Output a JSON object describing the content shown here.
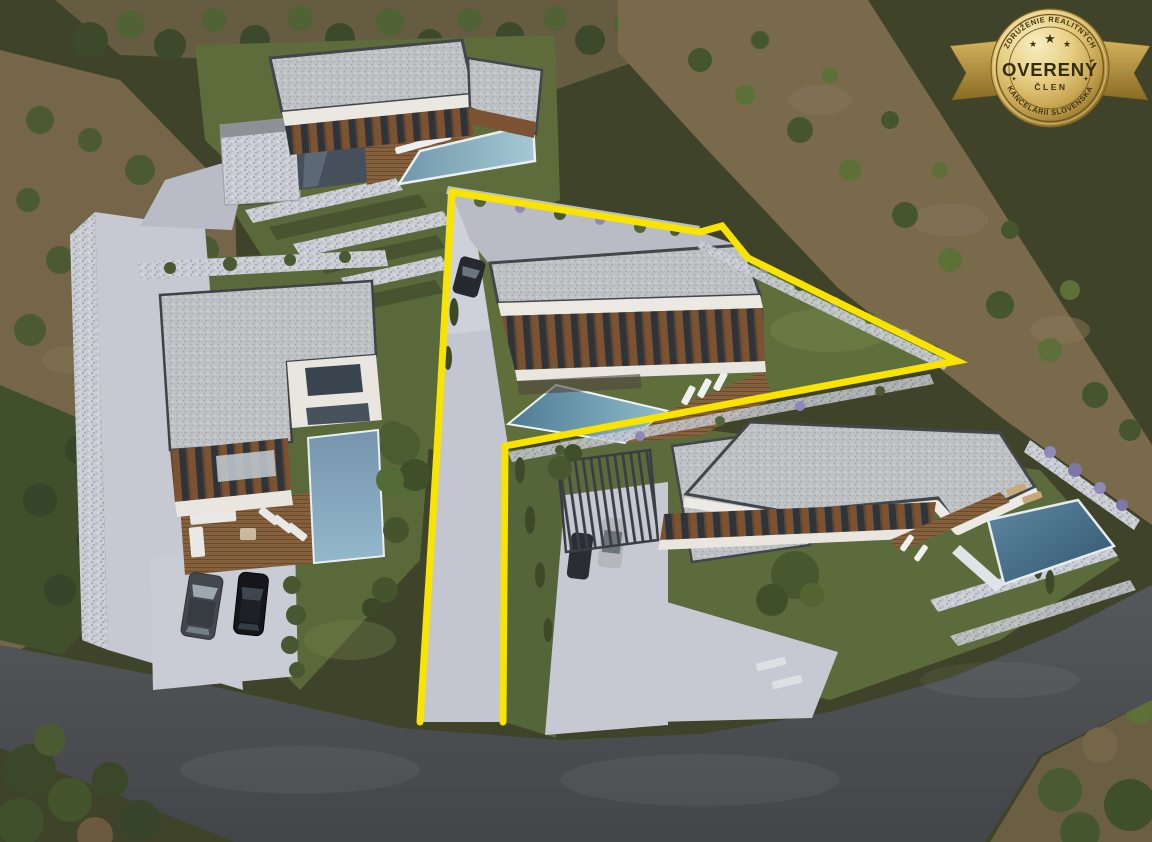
{
  "image": {
    "type": "aerial-3d-architectural-render",
    "description": "Drone-view 3D visualization of a hillside residential development with four modern flat-roof villas, swimming pools, driveways, parked cars and one building plot highlighted with a yellow outline",
    "width_px": 1152,
    "height_px": 842
  },
  "badge": {
    "top_text": "ZDRUŽENIE REALITNÝCH",
    "bottom_text": "KANCELÁRIÍ SLOVENSKA",
    "main_text": "OVERENÝ",
    "sub_text": "ČLEN",
    "star": "★",
    "side_mark": "✦",
    "colors": {
      "gold_light": "#f6e9b4",
      "gold_mid": "#d9b95f",
      "gold_dark": "#97772c",
      "text": "#3c3413"
    }
  },
  "scene": {
    "highlight_outline_color": "#f8e400",
    "background_olive": "#4c5233",
    "hillside_brown": "#75664a",
    "road_asphalt": "#4c4e52",
    "concrete_path": "#c6c8d2",
    "grass_green": "#5b6a3a",
    "roof_gravel": "#c0c3c5",
    "wall_white": "#ebe8e2",
    "wood_facade": "#7b5332",
    "pool_teal_light": "#a5c8d4",
    "pool_teal_dark": "#3a607a",
    "villa_count": 4,
    "pool_count": 4,
    "car_count": 5,
    "highlighted_plot_boundary_px": {
      "main_line": [
        [
          452,
          192
        ],
        [
          700,
          232
        ],
        [
          722,
          226
        ],
        [
          748,
          258
        ],
        [
          957,
          361
        ],
        [
          505,
          446
        ],
        [
          503,
          722
        ]
      ],
      "left_line": [
        [
          452,
          192
        ],
        [
          437,
          450
        ],
        [
          420,
          722
        ]
      ]
    }
  }
}
